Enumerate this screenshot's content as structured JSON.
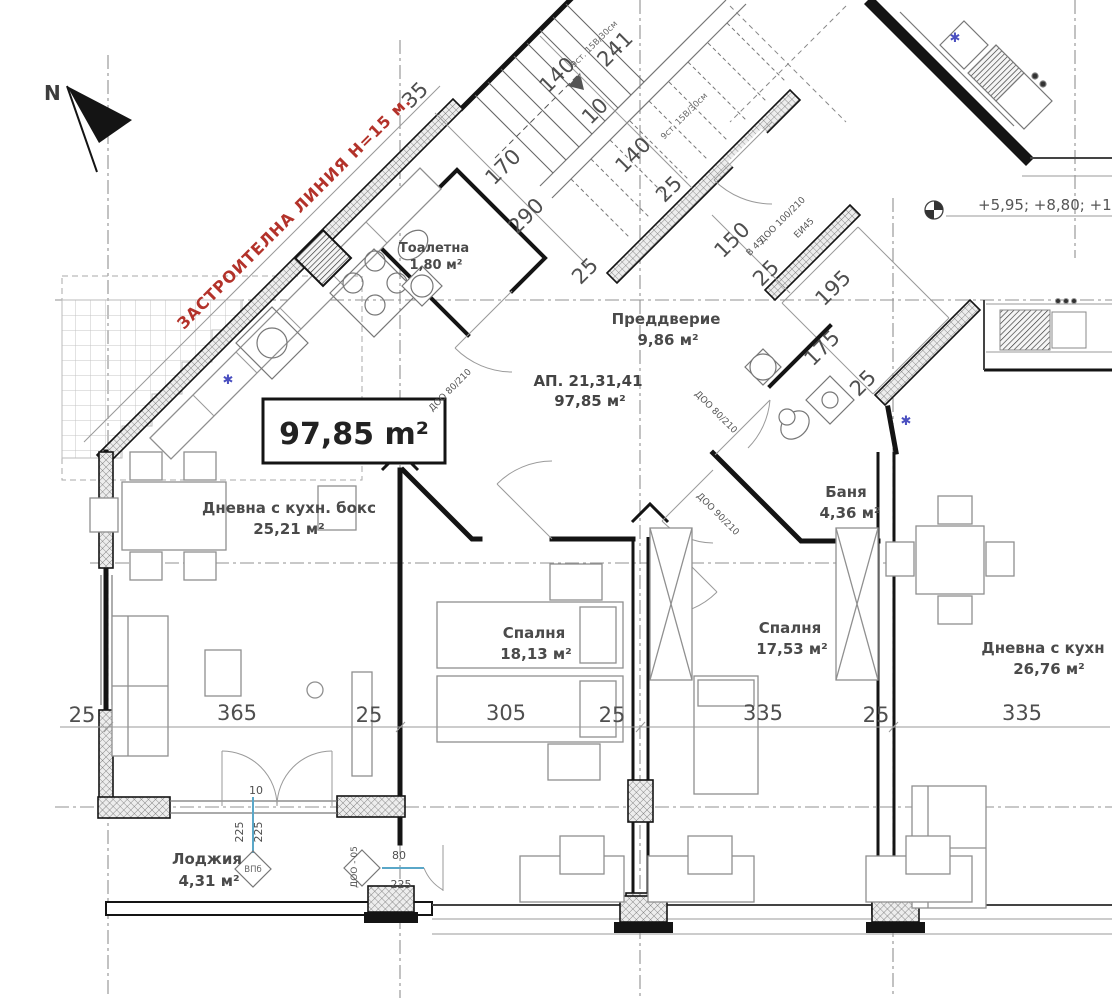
{
  "meta": {
    "drawing_type": "architectural floor plan",
    "language": "bg"
  },
  "compass": {
    "label": "N"
  },
  "building_line": {
    "text": "ЗАСТРОИТЕЛНА ЛИНИЯ Н=15 м."
  },
  "area_box": {
    "text": "97,85 m²"
  },
  "apartment": {
    "id": "АП. 21,31,41",
    "area": "97,85 м²"
  },
  "rooms": {
    "toilet": {
      "name": "Тоалетна",
      "area": "1,80 м²"
    },
    "entry": {
      "name": "Преддверие",
      "area": "9,86 м²"
    },
    "living": {
      "name": "Дневна с кухн. бокс",
      "area": "25,21 м²"
    },
    "bath": {
      "name": "Баня",
      "area": "4,36 м²"
    },
    "bedroom1": {
      "name": "Спалня",
      "area": "18,13 м²"
    },
    "bedroom2": {
      "name": "Спалня",
      "area": "17,53 м²"
    },
    "neighbor_living": {
      "name": "Дневна с кухн",
      "area": "26,76 м²"
    },
    "loggia": {
      "name": "Лоджия",
      "area": "4,31 м²"
    }
  },
  "dims": {
    "d25": "25",
    "d35": "35",
    "d170": "170",
    "d290": "290",
    "d140": "140",
    "d10": "10",
    "d241": "241",
    "d150": "150",
    "d195": "195",
    "d175": "175",
    "d305": "305",
    "d335": "335",
    "d365": "365",
    "d225": "225",
    "d80": "80"
  },
  "stairs": {
    "note": "9ст. 15В/30см"
  },
  "openings": {
    "door_80": "ДОО 80/210",
    "door_90": "ДОО 90/210",
    "door_100": "ДОО 100/210",
    "door_loggia": "ДОО - 05",
    "window_loggia": "ВПб",
    "fire_b45": "В 45",
    "fire_ei45": "ЕИ45"
  },
  "elevation": {
    "text": "+5,95; +8,80; +1"
  },
  "symbols": {
    "asterisk": "✱"
  },
  "colors": {
    "red": "#b3322a",
    "blue_symbol": "#4a4fc0",
    "blue_line": "#5aa7c8",
    "wall": "#141414"
  }
}
